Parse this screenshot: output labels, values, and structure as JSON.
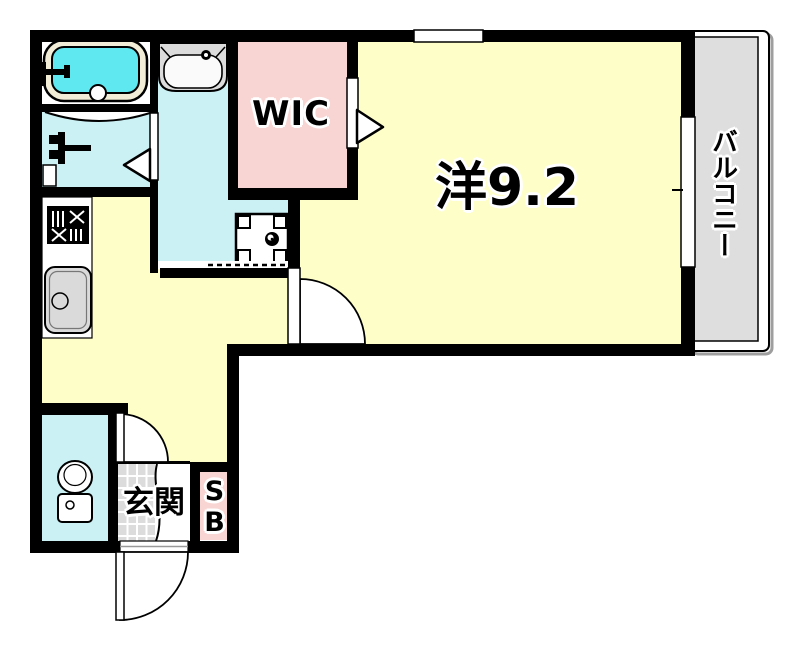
{
  "plan": {
    "labels": {
      "wic": "WIC",
      "main_room": "洋9.2",
      "balcony": "バルコニー",
      "entrance": "玄関",
      "shoe_box": "SB"
    },
    "colors": {
      "wall": "#000000",
      "room_yellow": "#FEFEC8",
      "wet_cyan": "#CBF1F5",
      "closet_pink": "#F8D5D2",
      "balcony_gray": "#DEDEDE",
      "tub_water": "#5FE8F0",
      "tub_rim": "#F2EDD6",
      "fixture_gray": "#DCDCDC",
      "tile_gray": "#DCDCDC"
    }
  }
}
